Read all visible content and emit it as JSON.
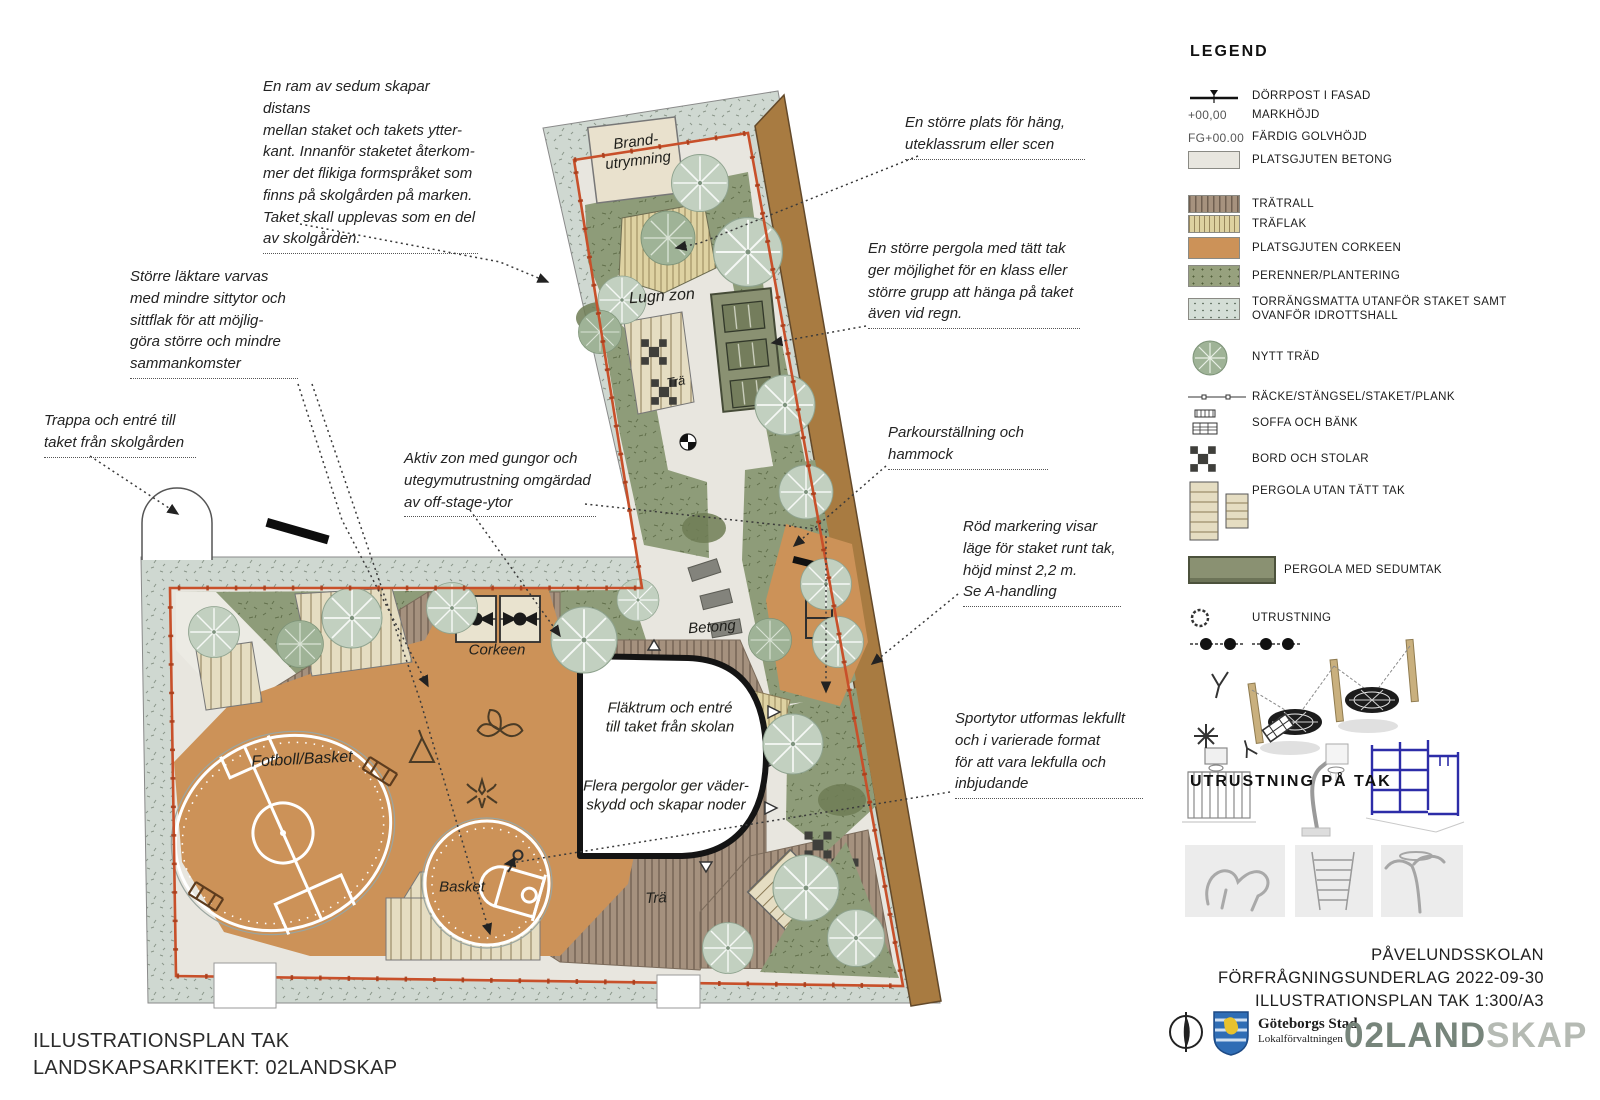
{
  "plan": {
    "labels": {
      "brandutrymning": "Brand-\nutrymning",
      "lugn_zon": "Lugn zon",
      "tra_small": "Trä",
      "corkeen": "Corkeen",
      "betong": "Betong",
      "fotboll_basket": "Fotboll/Basket",
      "basket": "Basket",
      "tra_large": "Trä",
      "flaktrum": "Fläktrum och entré\ntill taket från skolan",
      "pergolor": "Flera pergolor ger väder-\nskydd och skapar noder"
    },
    "annotations": [
      "En ram av sedum skapar distans\nmellan staket och takets ytter-\nkant. Innanför staketet återkom-\nmer det flikiga formspråket som\nfinns på skolgården på marken.\nTaket skall upplevas som en del\nav skolgården.",
      "Större läktare varvas\nmed mindre sittytor och\nsittflak för att möjlig-\ngöra större och mindre\nsammankomster",
      "Trappa och entré till\ntaket från skolgården",
      "Aktiv zon med gungor och\nutegymutrustning omgärdad\nav off-stage-ytor",
      "En större plats för häng,\nuteklassrum eller scen",
      "En större pergola med tätt tak\nger möjlighet för en klass eller\nstörre grupp att hänga på taket\näven vid regn.",
      "Parkourställning och\nhammock",
      "Röd markering visar\nläge för staket runt tak,\nhöjd minst 2,2 m.\nSe A-handling",
      "Sportytor utformas lekfullt\noch i varierade format\nför att vara lekfulla och\ninbjudande"
    ]
  },
  "legend": {
    "title": "LEGEND",
    "mark_symbol": "+00,00",
    "fg_symbol": "FG+00.00",
    "items": [
      "DÖRRPOST I FASAD",
      "MARKHÖJD",
      "FÄRDIG GOLVHÖJD",
      "PLATSGJUTEN BETONG",
      "TRÄTRALL",
      "TRÄFLAK",
      "PLATSGJUTEN CORKEEN",
      "PERENNER/PLANTERING",
      "TORRÄNGSMATTA UTANFÖR STAKET SAMT\nOVANFÖR IDROTTSHALL",
      "NYTT TRÄD",
      "RÄCKE/STÄNGSEL/STAKET/PLANK",
      "SOFFA OCH BÄNK",
      "BORD OCH STOLAR",
      "PERGOLA UTAN TÄTT TAK",
      "PERGOLA MED SEDUMTAK",
      "UTRUSTNING"
    ],
    "equipment_title": "UTRUSTNING PÅ TAK"
  },
  "titleblock": {
    "lines": "PÅVELUNDSSKOLAN\nFÖRFRÅGNINGSUNDERLAG 2022-09-30\nILLUSTRATIONSPLAN TAK 1:300/A3",
    "logo_name": "Göteborgs Stad",
    "logo_sub": "Lokalförvaltningen",
    "brand_strong": "02LAND",
    "brand_light": "SKAP"
  },
  "footer": {
    "lines": "ILLUSTRATIONSPLAN TAK\nLANDSKAPSARKITEKT: 02LANDSKAP"
  },
  "colors": {
    "corkeen_orange": "#cc9258",
    "fence_red": "#c8502a",
    "sedum_brown": "#a87b41",
    "planting_green": "#8e9c79",
    "torrangsmatta": "#cfd8d1",
    "betong_gray": "#e8e6df",
    "pergola_sedum": "#8a9172",
    "brand_green_gray": "#77857b"
  }
}
